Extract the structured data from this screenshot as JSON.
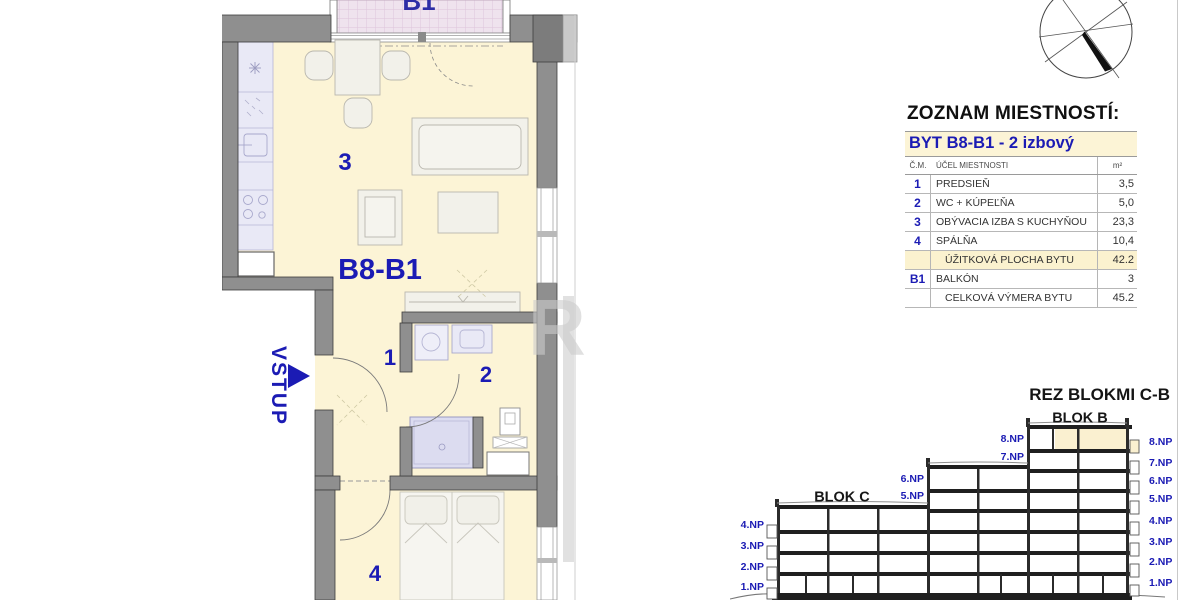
{
  "plan": {
    "apartment_label": "B8-B1",
    "entrance_label": "VSTUP",
    "balcony_label": "B1",
    "rooms": {
      "hall": "1",
      "bath": "2",
      "living": "3",
      "bedroom": "4"
    }
  },
  "watermark_letter": "R",
  "room_table": {
    "title": "ZOZNAM MIESTNOSTÍ:",
    "subtitle": "BYT B8-B1 - 2 izbový",
    "columns": {
      "num": "Č.M.",
      "purpose": "ÚČEL MIESTNOSTI",
      "area": "m²"
    },
    "rows": [
      {
        "num": "1",
        "name": "PREDSIEŇ",
        "area": "3,5"
      },
      {
        "num": "2",
        "name": "WC + KÚPEĽŇA",
        "area": "5,0"
      },
      {
        "num": "3",
        "name": "OBÝVACIA IZBA S KUCHYŇOU",
        "area": "23,3"
      },
      {
        "num": "4",
        "name": "SPÁLŇA",
        "area": "10,4"
      },
      {
        "num": "",
        "name": "ÚŽITKOVÁ PLOCHA BYTU",
        "area": "42.2"
      },
      {
        "num": "B1",
        "name": "BALKÓN",
        "area": "3"
      },
      {
        "num": "",
        "name": "CELKOVÁ VÝMERA BYTU",
        "area": "45.2"
      }
    ]
  },
  "section": {
    "title": "REZ BLOKMI C-B",
    "blocks": {
      "c": "BLOK C",
      "b": "BLOK B"
    },
    "left_levels": [
      "4.NP",
      "3.NP",
      "2.NP",
      "1.NP"
    ],
    "mid_levels": [
      "6.NP",
      "5.NP"
    ],
    "upper_levels": [
      "8.NP",
      "7.NP"
    ],
    "right_levels": [
      "8.NP",
      "7.NP",
      "6.NP",
      "5.NP",
      "4.NP",
      "3.NP",
      "2.NP",
      "1.NP"
    ]
  },
  "colors": {
    "accent_blue": "#1b1bb4",
    "floor_cream": "#fcf4d6",
    "wall_gray": "#8f8f8f",
    "fixture_lavender": "#e9e9f6",
    "balcony_pink": "#efe3ee",
    "highlight_cream": "#fbf2cf"
  }
}
